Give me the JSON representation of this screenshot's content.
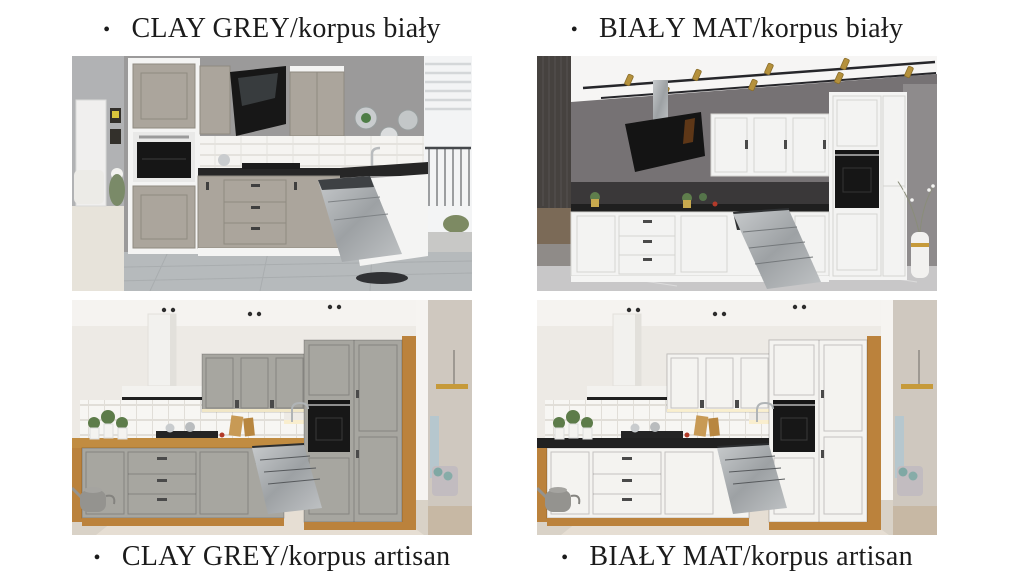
{
  "page": {
    "background_hex": "#ffffff",
    "text_hex": "#1b1b1b"
  },
  "captions": {
    "bullet": "•",
    "items": [
      {
        "id": "top-left",
        "text": "CLAY GREY/korpus biały"
      },
      {
        "id": "top-right",
        "text": "BIAŁY MAT/korpus biały"
      },
      {
        "id": "bottom-left",
        "text": "CLAY GREY/korpus artisan"
      },
      {
        "id": "bottom-right",
        "text": "BIAŁY MAT/korpus artisan"
      }
    ]
  },
  "kitchens": [
    {
      "name": "CLAY GREY/korpus biały",
      "front_color_name": "clay grey",
      "korpus_color_name": "biały",
      "front_hex": "#aba59c",
      "korpus_hex": "#f4f4f3",
      "countertop_hex": "#262626",
      "wall_hex": "#9b9a9a",
      "floor_hex": "#b6babc",
      "visible_features": [
        "black angled glass hood",
        "black built-in oven",
        "open dishwasher door",
        "white tile backsplash",
        "balcony window",
        "round wall plates",
        "adjacent room with armchair"
      ]
    },
    {
      "name": "BIAŁY MAT/korpus biały",
      "front_color_name": "biały mat",
      "korpus_color_name": "biały",
      "front_hex": "#f3f3f2",
      "korpus_hex": "#f4f4f3",
      "countertop_hex": "#1f1f1f",
      "wall_hex": "#767274",
      "floor_hex": "#c8c7c8",
      "visible_features": [
        "ceiling track with brass spotlights",
        "black angled glass hood",
        "black built-in oven",
        "open dishwasher door",
        "white vase with branches",
        "plants in yellow pots"
      ]
    },
    {
      "name": "CLAY GREY/korpus artisan",
      "front_color_name": "clay grey",
      "korpus_color_name": "artisan oak",
      "front_hex": "#a7a6a0",
      "korpus_hex": "#bb823c",
      "countertop_hex": "#c18c41",
      "wall_hex": "#edeae5",
      "floor_hex": "#d9d2c7",
      "visible_features": [
        "white chimney hood",
        "black built-in oven",
        "open dishwasher door",
        "white square tile backsplash",
        "oak worktop and plinth",
        "watering can",
        "doorway to living room"
      ]
    },
    {
      "name": "BIAŁY MAT/korpus artisan",
      "front_color_name": "biały mat",
      "korpus_color_name": "artisan oak",
      "front_hex": "#f4f3f0",
      "korpus_hex": "#bb823c",
      "countertop_hex": "#212121",
      "wall_hex": "#edeae5",
      "floor_hex": "#d9d2c7",
      "visible_features": [
        "white chimney hood",
        "black built-in oven",
        "open dishwasher door",
        "white square tile backsplash",
        "black worktop",
        "oak carcass and plinth",
        "doorway to living room"
      ]
    }
  ]
}
